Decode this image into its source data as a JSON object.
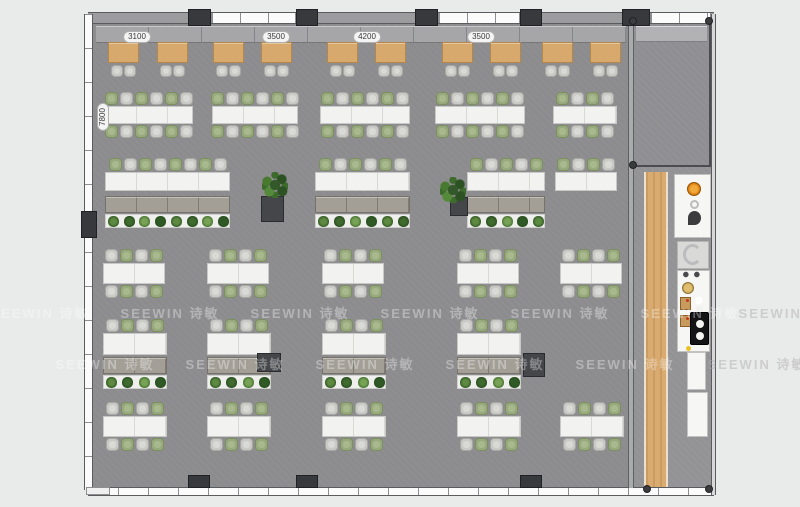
{
  "watermark": {
    "text": "SEEWIN 诗敏",
    "rows": [
      {
        "y": 303,
        "xs": [
          40,
          170,
          300,
          430,
          560,
          690
        ],
        "dark_xs": [
          788
        ]
      },
      {
        "y": 354,
        "xs": [
          105,
          235,
          365,
          495,
          625
        ],
        "dark_xs": [
          757
        ]
      }
    ]
  },
  "dimensions": {
    "top": [
      {
        "text": "3100",
        "x": 137,
        "y": 31
      },
      {
        "text": "3500",
        "x": 276,
        "y": 31
      },
      {
        "text": "4200",
        "x": 367,
        "y": 31
      },
      {
        "text": "3500",
        "x": 481,
        "y": 31
      }
    ],
    "side": {
      "text": "7800",
      "x": 103,
      "y": 117
    }
  },
  "palette": {
    "floor": "#8c8c8f",
    "corridor_floor": "#939396",
    "wood": "#d8a96d",
    "desk_white": "#f2f2f0",
    "chair_gray": "#c9c9c5",
    "chair_green": "#97a97d",
    "cabinet": "#9a958d",
    "plant_green": "#2c4a22",
    "column_dark": "#38393c",
    "sink_orange": "#d97f0e",
    "watermark_white": "#ffffff"
  },
  "floorplan": {
    "meeting_tables": {
      "y": 42,
      "w": 31,
      "h": 21,
      "xs": [
        108,
        157,
        213,
        261,
        327,
        375,
        442,
        490,
        542,
        590
      ]
    },
    "bench_rows": [
      {
        "desk_y": 106,
        "desk_h": 18,
        "first": "green",
        "clusters": [
          {
            "x": 105,
            "w": 88
          },
          {
            "x": 212,
            "w": 86
          },
          {
            "x": 320,
            "w": 90
          },
          {
            "x": 435,
            "w": 90
          },
          {
            "x": 553,
            "w": 64
          }
        ]
      },
      {
        "desk_y": 263,
        "desk_h": 21,
        "first": "gray",
        "clusters": [
          {
            "x": 103,
            "w": 62
          },
          {
            "x": 207,
            "w": 62
          },
          {
            "x": 322,
            "w": 62
          },
          {
            "x": 457,
            "w": 62
          },
          {
            "x": 560,
            "w": 62
          }
        ]
      },
      {
        "desk_y": 416,
        "desk_h": 21,
        "first": "gray",
        "clusters": [
          {
            "x": 103,
            "w": 64
          },
          {
            "x": 207,
            "w": 64
          },
          {
            "x": 322,
            "w": 64
          },
          {
            "x": 457,
            "w": 64
          },
          {
            "x": 560,
            "w": 64
          }
        ]
      }
    ],
    "storage_rows": [
      {
        "desk_y": 172,
        "desk_h": 19,
        "cab_y": 196,
        "first": "green",
        "clusters": [
          {
            "x": 105,
            "w": 125,
            "cab": true
          },
          {
            "x": 315,
            "w": 95,
            "cab": true
          },
          {
            "x": 467,
            "w": 78,
            "cab": true
          },
          {
            "x": 555,
            "w": 62,
            "cab": false
          }
        ],
        "blocks": [
          {
            "x": 261,
            "y": 196,
            "w": 23,
            "h": 26
          },
          {
            "x": 450,
            "y": 197,
            "w": 18,
            "h": 19
          }
        ]
      },
      {
        "desk_y": 333,
        "desk_h": 22,
        "cab_y": 357,
        "first": "gray",
        "clusters": [
          {
            "x": 103,
            "w": 64,
            "cab": true
          },
          {
            "x": 207,
            "w": 64,
            "cab": true
          },
          {
            "x": 322,
            "w": 64,
            "cab": true
          },
          {
            "x": 457,
            "w": 64,
            "cab": true
          }
        ],
        "blocks": [
          {
            "x": 257,
            "y": 353,
            "w": 24,
            "h": 19
          },
          {
            "x": 523,
            "y": 353,
            "w": 22,
            "h": 24
          }
        ]
      }
    ],
    "floor_plants": [
      {
        "x": 262,
        "y": 172
      },
      {
        "x": 440,
        "y": 177
      }
    ]
  },
  "structure": {
    "glazing_top": [
      {
        "x": 5,
        "w": 95,
        "glass": false
      },
      {
        "x": 123,
        "w": 85,
        "glass": true
      },
      {
        "x": 230,
        "w": 97,
        "glass": false
      },
      {
        "x": 350,
        "w": 82,
        "glass": true
      },
      {
        "x": 454,
        "w": 80,
        "glass": false
      },
      {
        "x": 562,
        "w": 61,
        "glass": true
      }
    ],
    "top_columns": [
      {
        "x": 188,
        "w": 23
      },
      {
        "x": 296,
        "w": 22
      },
      {
        "x": 415,
        "w": 23
      },
      {
        "x": 520,
        "w": 22
      },
      {
        "x": 622,
        "w": 28
      }
    ],
    "bottom_columns": [
      {
        "x": 188,
        "w": 22
      },
      {
        "x": 296,
        "w": 22
      },
      {
        "x": 520,
        "w": 22
      }
    ],
    "left_column": {
      "x": 81,
      "y": 211,
      "w": 16,
      "h": 27
    },
    "corner_dots": [
      [
        629,
        17
      ],
      [
        705,
        17
      ],
      [
        629,
        161
      ],
      [
        643,
        485
      ],
      [
        705,
        485
      ]
    ]
  },
  "kitchen": {
    "wood_floor": {
      "x": 644,
      "y": 172,
      "w": 24,
      "h": 315
    },
    "fixtures": [
      {
        "cls": "kx-panel",
        "name": "pantry-counter",
        "x": 674,
        "y": 174,
        "w": 37,
        "h": 64
      },
      {
        "cls": "kx-orange",
        "name": "sink-bowl-icon",
        "x": 687,
        "y": 182,
        "w": 14,
        "h": 14
      },
      {
        "cls": "kx-ring",
        "name": "drain-icon",
        "x": 690,
        "y": 200,
        "w": 9,
        "h": 9
      },
      {
        "cls": "kx-speaker",
        "name": "faucet-icon",
        "x": 688,
        "y": 211,
        "w": 13,
        "h": 14
      },
      {
        "cls": "kx-gray-panel",
        "name": "appliance-panel",
        "x": 677,
        "y": 241,
        "w": 32,
        "h": 28
      },
      {
        "cls": "kx-cshape",
        "name": "kettle-icon",
        "x": 683,
        "y": 244,
        "w": 19,
        "h": 21
      },
      {
        "cls": "kx-counter",
        "name": "kitchen-counter",
        "x": 677,
        "y": 270,
        "w": 33,
        "h": 82
      },
      {
        "cls": "kx-taps",
        "name": "taps-icon",
        "x": 681,
        "y": 271,
        "w": 22,
        "h": 7
      },
      {
        "cls": "kx-gold",
        "name": "bowl-icon",
        "x": 682,
        "y": 282,
        "w": 12,
        "h": 12
      },
      {
        "cls": "kx-wood",
        "name": "cutting-board-icon",
        "x": 680,
        "y": 297,
        "w": 11,
        "h": 13
      },
      {
        "cls": "kx-dots",
        "name": "plates-icon",
        "x": 694,
        "y": 296,
        "w": 10,
        "h": 18
      },
      {
        "cls": "kx-wood",
        "name": "cutting-board-icon",
        "x": 680,
        "y": 315,
        "w": 11,
        "h": 12
      },
      {
        "cls": "kx-cooktop",
        "name": "cooktop",
        "x": 690,
        "y": 312,
        "w": 19,
        "h": 33
      },
      {
        "cls": "kx-dot-yellow",
        "name": "knob-icon",
        "x": 686,
        "y": 346,
        "w": 5,
        "h": 5
      },
      {
        "cls": "kx-cab",
        "name": "cabinet",
        "x": 687,
        "y": 352,
        "w": 19,
        "h": 38
      },
      {
        "cls": "kx-cab",
        "name": "cabinet",
        "x": 687,
        "y": 392,
        "w": 21,
        "h": 45
      }
    ]
  }
}
